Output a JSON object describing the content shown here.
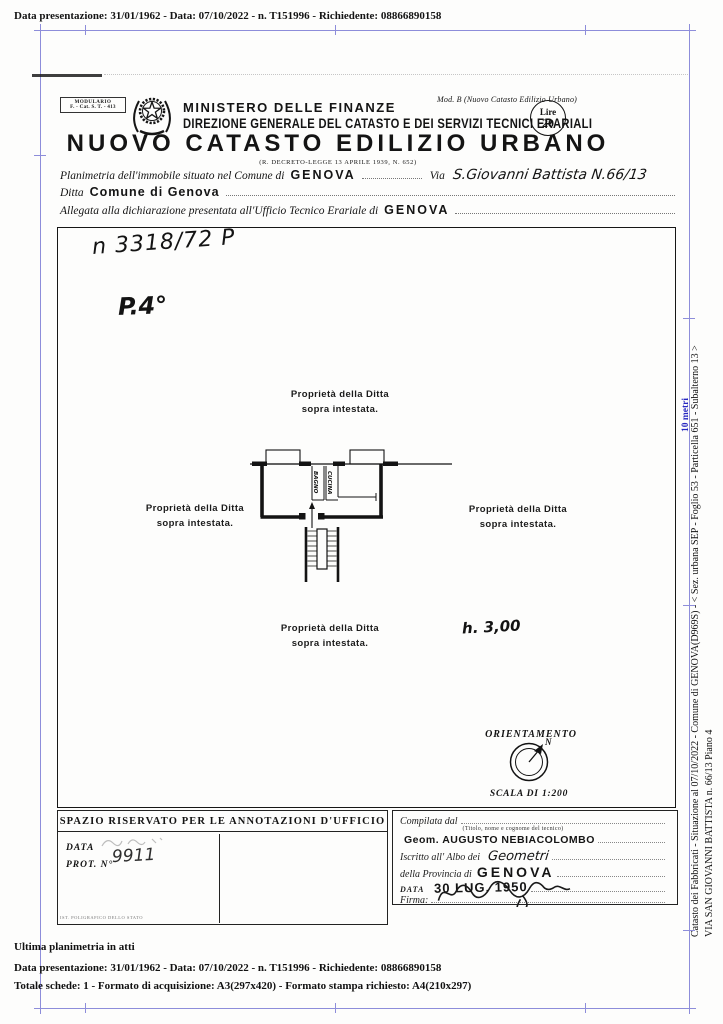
{
  "colors": {
    "frame_blue": "#8d8dda",
    "annotation_blue": "#2626c0",
    "ink": "#141414"
  },
  "top_strip": {
    "text": "Data presentazione: 31/01/1962 - Data: 07/10/2022 - n. T151996 - Richiedente: 08866890158"
  },
  "header": {
    "modulario_l1": "MODULARIO",
    "modulario_l2": "F. - Cat. S. T. - 413",
    "mod_b": "Mod. B (Nuovo Catasto Edilizio Urbano)",
    "ministero": "MINISTERO DELLE FINANZE",
    "direzione": "DIREZIONE GENERALE DEL CATASTO E DEI SERVIZI TECNICI ERARIALI",
    "title": "NUOVO CATASTO EDILIZIO URBANO",
    "decreto": "(R. DECRETO-LEGGE 13 APRILE 1939, N. 652)",
    "lire_l1": "Lire",
    "lire_l2": "20"
  },
  "form": {
    "planimetria_label": "Planimetria dell'immobile situato nel Comune di",
    "comune_value": "GENOVA",
    "via_label": "Via",
    "via_value": "S.Giovanni Battista N.66/13",
    "ditta_label": "Ditta",
    "ditta_value": "Comune di Genova",
    "allegata_label": "Allegata alla dichiarazione presentata all'Ufficio Tecnico Erariale di",
    "ufficio_value": "GENOVA"
  },
  "plan": {
    "doc_number": "n 3318/72 P",
    "floor_label": "P.4°",
    "prop_line1": "Proprietà della Ditta",
    "prop_line2": "sopra intestata.",
    "room_bagno": "BAGNO",
    "room_cucina": "CUCINA",
    "height_note": "h. 3,00",
    "orientamento": "ORIENTAMENTO",
    "north_label": "N",
    "scala": "SCALA DI 1:200"
  },
  "office_box": {
    "title": "SPAZIO RISERVATO PER LE ANNOTAZIONI D'UFFICIO",
    "data_label": "DATA",
    "prot_label": "PROT. N°",
    "prot_value": "9911",
    "print_credit": "IST. POLIGRAFICO DELLO STATO"
  },
  "compiler_box": {
    "compilata_label": "Compilata dal",
    "tecnico_note": "(Titolo, nome e cognome del tecnico)",
    "tecnico_name": "Geom. AUGUSTO NEBIACOLOMBO",
    "albo_label": "Iscritto all' Albo dei",
    "albo_value": "Geometri",
    "provincia_label": "della Provincia di",
    "provincia_value": "GENOVA",
    "data_label": "DATA",
    "data_value": "30 LUG. 1950",
    "firma_label": "Firma:"
  },
  "right_margin": {
    "line1": "Catasto dei Fabbricati - Situazione al 07/10/2022 - Comune di GENOVA(D969S) - < Sez. urbana SEP - Foglio 53 - Particella 651 - Subalterno 13 >",
    "line2": "VIA SAN GIOVANNI BATTISTA n. 66/13 Piano 4",
    "scale_note": "10 metri"
  },
  "footer": {
    "line1": "Ultima planimetria in atti",
    "line2": "Data presentazione: 31/01/1962 - Data: 07/10/2022 - n. T151996 - Richiedente: 08866890158",
    "line3": "Totale schede: 1 - Formato di acquisizione: A3(297x420) - Formato stampa richiesto: A4(210x297)"
  }
}
